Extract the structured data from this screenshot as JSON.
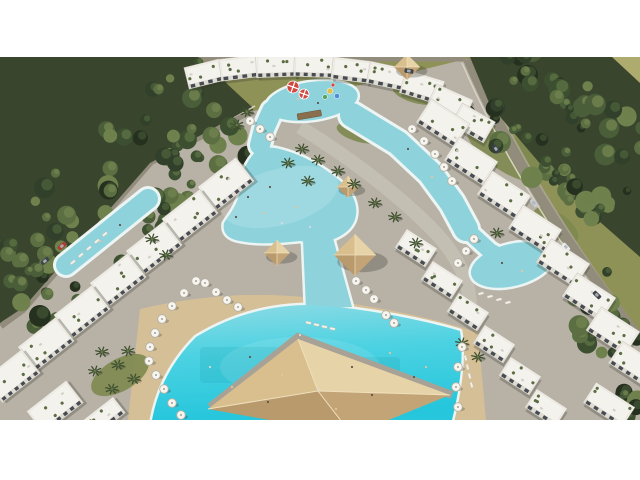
{
  "image": {
    "type": "aerial-architectural-render",
    "subject": "resort-complex-with-lagoon-pools"
  },
  "layout_px": {
    "canvas_w": 640,
    "canvas_h": 363,
    "offset_top": 57
  },
  "scene": {
    "colors": {
      "white": "#ffffff",
      "field": "#8f9257",
      "fieldLight": "#aeab6e",
      "khaki": "#b6ac85",
      "forestBase": "#39462d",
      "treeLight": "#8a9158",
      "paving": "#b7b1a6",
      "pavingLight": "#c9c4b9",
      "sand": "#d5bf97",
      "shore": "#ecf5f3",
      "lagoon": "#8ed3dc",
      "poolTop": "#8fdbe4",
      "poolMid": "#4cd2e2",
      "poolDeep": "#26c6dc",
      "building": "#f4f2ec",
      "buildingShade": "#dedbd2",
      "buildingEdge": "#c6c3b9",
      "roofLine": "#e9e7df",
      "window": "#474b52",
      "roofGreen": "#5c6d44",
      "roofGrey": "#d2cfc6",
      "road": "#928c7c",
      "roadLight": "#a8a291",
      "wall": "#d8d2c2",
      "wallShadow": "rgba(30,35,25,0.4)",
      "shadow": "rgba(45,50,40,0.28)",
      "umbrellaFill": "#f7f5ef",
      "umbrellaEdge": "#b5b1a5",
      "umbrellaDot": "#a39f93",
      "lounger": "#f2f0e8",
      "loungerEdge": "#c2beb2",
      "palm": "#3f5030",
      "palmLight": "#637744",
      "grass": "#7e8950",
      "hutFill": "#d9be8e",
      "hutShade": "#c3a476",
      "hutDark": "#b89a6c",
      "hutLight": "#e7d3a8",
      "ridge": "#efe0bc",
      "pyrWalk": "#a8a296",
      "carDark": "#3f434a",
      "carSilver": "#c9cdd1",
      "carWhite": "#ecedee",
      "carRed": "#b03a31",
      "glass": "#aeb6bc",
      "stripeRed": "#d2473f",
      "slideYellow": "#e3bf4e",
      "slideBlue": "#4d8fd2",
      "slideGreen": "#58a45c",
      "bridge": "#8a6f4e",
      "skin": "#e5c5a0",
      "dark": "#5d564c",
      "laneTint": "rgba(20,150,160,0.16)"
    },
    "treeGreens": [
      "#26301f",
      "#31402a",
      "#3d4f31",
      "#4a5e3a",
      "#5b6f42",
      "#6f814c"
    ],
    "backdrop": {
      "khakiPoly": "0,0 118,0 0,86",
      "fieldLightPoly": "604,0 640,0 640,30",
      "forestPolys": [
        "M0,0 L198,0 L252,50 L150,106 L24,250 L0,266 Z",
        "M470,0 L612,0 L640,26 L640,200 L560,130 L490,48 Z"
      ]
    },
    "forestStrips": [
      [
        -15,
        248,
        235,
        38,
        58,
        90,
        7
      ],
      [
        486,
        20,
        638,
        132,
        55,
        70,
        13
      ],
      [
        580,
        225,
        638,
        330,
        30,
        16,
        21
      ],
      [
        610,
        342,
        640,
        360,
        14,
        8,
        29
      ]
    ],
    "roads": {
      "left": {
        "d": "M252,52 L150,104 L22,252 L0,268",
        "w": 9
      },
      "leftWall": "M255,49 L152,100 L24,248 L2,264",
      "leftShadow": "M248,47 L146,99 L18,247",
      "right": {
        "d": "M468,2 C500,78 552,170 640,282",
        "w": 10
      },
      "rightWall": "M462,6 C495,82 546,172 634,286",
      "rightOuter": "M474,0 C507,76 558,168 640,276",
      "top": {
        "d": "M150,2 L466,2",
        "w": 5
      },
      "path1": {
        "d": "M300,70 Q380,120 430,170 Q470,210 470,250",
        "w": 14
      }
    },
    "grassPatches": [
      [
        505,
        95,
        45,
        18,
        35
      ],
      [
        556,
        168,
        26,
        12,
        35
      ],
      [
        420,
        36,
        28,
        11,
        12
      ],
      [
        120,
        318,
        32,
        16,
        -30
      ],
      [
        360,
        76,
        24,
        9,
        15
      ]
    ],
    "sandPoly": "M140,252 C200,238 260,234 320,242 C380,250 440,262 478,276 L486,363 L128,363 Z",
    "water": {
      "shapes": [
        {
          "t": "ellipse",
          "cx": 312,
          "cy": 44,
          "rx": 46,
          "ry": 19,
          "rot": -8
        },
        {
          "t": "line",
          "pts": [
            [
              272,
              54
            ],
            [
              264,
              72
            ],
            [
              260,
              88
            ]
          ],
          "w": 20
        },
        {
          "t": "path",
          "d": "M258,92 C246,104 240,118 240,132 C238,148 230,156 224,166 C222,176 228,182 240,184 C260,188 280,186 300,184 L308,185 L334,182 C350,176 358,164 356,150 C354,136 344,126 330,116 C314,104 296,96 280,92 C272,90 264,90 258,92 Z"
        },
        {
          "t": "line",
          "pts": [
            [
              352,
              58
            ],
            [
              398,
              86
            ],
            [
              430,
              116
            ],
            [
              452,
              146
            ],
            [
              466,
              172
            ]
          ],
          "w": 24
        },
        {
          "t": "line",
          "pts": [
            [
              466,
              172
            ],
            [
              490,
              194
            ],
            [
              508,
              204
            ]
          ],
          "w": 16
        },
        {
          "t": "ellipse",
          "cx": 512,
          "cy": 208,
          "rx": 42,
          "ry": 21,
          "rot": -14
        },
        {
          "t": "line",
          "pts": [
            [
              148,
              142
            ],
            [
              66,
              208
            ]
          ],
          "w": 20
        },
        {
          "t": "path",
          "d": "M303,183 L333,181 L352,250 L306,252 Z"
        },
        {
          "t": "path",
          "d": "M196,280 C232,258 270,248 310,248 C356,250 420,262 460,274 C464,300 460,330 452,363 L152,363 C158,330 174,302 196,280 Z",
          "fill": "gradient"
        }
      ],
      "lanes": [
        [
          200,
          290,
          80,
          36
        ],
        [
          310,
          300,
          90,
          42
        ]
      ],
      "shallow": [
        [
          280,
          140,
          60,
          28,
          -15,
          0.14
        ],
        [
          300,
          310,
          80,
          30,
          0,
          0.1
        ]
      ]
    },
    "buildingClusters": [
      {
        "name": "top-arc",
        "blocks": [
          [
            186,
            6,
            36,
            22,
            -14
          ],
          [
            220,
            0,
            38,
            22,
            -7
          ],
          [
            256,
            -2,
            40,
            22,
            -2
          ],
          [
            294,
            -2,
            40,
            22,
            2
          ],
          [
            332,
            2,
            38,
            22,
            7
          ],
          [
            368,
            8,
            38,
            22,
            12
          ],
          [
            402,
            18,
            40,
            24,
            17
          ],
          [
            430,
            34,
            40,
            24,
            24
          ],
          [
            454,
            54,
            38,
            24,
            30
          ]
        ]
      },
      {
        "name": "left-row",
        "angle": -38,
        "blocks": [
          [
            202,
            112,
            48,
            30
          ],
          [
            166,
            144,
            48,
            30
          ],
          [
            130,
            176,
            48,
            30
          ],
          [
            94,
            208,
            48,
            30
          ],
          [
            58,
            240,
            48,
            30
          ],
          [
            22,
            272,
            48,
            30
          ],
          [
            -12,
            304,
            48,
            30
          ],
          [
            30,
            336,
            50,
            28
          ],
          [
            78,
            352,
            46,
            20
          ]
        ]
      },
      {
        "name": "right-row-upper",
        "angle": 33,
        "blocks": [
          [
            420,
            52,
            46,
            28
          ],
          [
            448,
            90,
            46,
            28
          ],
          [
            481,
            124,
            46,
            28
          ],
          [
            512,
            158,
            46,
            28
          ],
          [
            540,
            192,
            46,
            28
          ],
          [
            566,
            226,
            46,
            28
          ],
          [
            590,
            260,
            46,
            28
          ],
          [
            612,
            294,
            44,
            26
          ],
          [
            586,
            336,
            46,
            24
          ]
        ]
      },
      {
        "name": "right-row-lower",
        "angle": 33,
        "blocks": [
          [
            398,
            180,
            36,
            22
          ],
          [
            424,
            212,
            36,
            22
          ],
          [
            450,
            244,
            36,
            22
          ],
          [
            476,
            276,
            36,
            22
          ],
          [
            502,
            308,
            36,
            22
          ],
          [
            528,
            340,
            36,
            22
          ]
        ]
      }
    ],
    "huts": [
      [
        348,
        130,
        22
      ],
      [
        277,
        196,
        26
      ],
      [
        355,
        198,
        42
      ],
      [
        407,
        10,
        26
      ]
    ],
    "pyramid": {
      "walkway": "M210,350 L298,280 L452,338",
      "apex": [
        318,
        334
      ],
      "corners": {
        "n": [
          298,
          282
        ],
        "e": [
          450,
          338
        ],
        "s": [
          352,
          378
        ],
        "w": [
          208,
          352
        ]
      }
    },
    "umbrellas": [
      [
        196,
        224
      ],
      [
        184,
        236
      ],
      [
        172,
        249
      ],
      [
        162,
        262
      ],
      [
        155,
        276
      ],
      [
        150,
        290
      ],
      [
        149,
        304
      ],
      [
        156,
        318
      ],
      [
        164,
        332
      ],
      [
        172,
        346
      ],
      [
        181,
        358
      ],
      [
        205,
        226
      ],
      [
        216,
        235
      ],
      [
        227,
        243
      ],
      [
        238,
        250
      ],
      [
        250,
        64
      ],
      [
        260,
        72
      ],
      [
        270,
        80
      ],
      [
        412,
        72
      ],
      [
        424,
        84
      ],
      [
        435,
        97
      ],
      [
        444,
        110
      ],
      [
        452,
        124
      ],
      [
        474,
        182
      ],
      [
        466,
        194
      ],
      [
        458,
        206
      ],
      [
        356,
        224
      ],
      [
        366,
        233
      ],
      [
        374,
        242
      ],
      [
        386,
        258
      ],
      [
        394,
        266
      ],
      [
        462,
        290
      ],
      [
        458,
        310
      ],
      [
        456,
        330
      ],
      [
        458,
        350
      ]
    ],
    "palms": [
      [
        302,
        92
      ],
      [
        318,
        103
      ],
      [
        338,
        114
      ],
      [
        354,
        127
      ],
      [
        288,
        106
      ],
      [
        308,
        124
      ],
      [
        375,
        146
      ],
      [
        395,
        160
      ],
      [
        152,
        182
      ],
      [
        166,
        198
      ],
      [
        102,
        295
      ],
      [
        118,
        308
      ],
      [
        134,
        322
      ],
      [
        112,
        332
      ],
      [
        95,
        314
      ],
      [
        128,
        294
      ],
      [
        247,
        55
      ],
      [
        237,
        68
      ],
      [
        462,
        286
      ],
      [
        478,
        300
      ],
      [
        497,
        176
      ],
      [
        416,
        186
      ]
    ],
    "loungerRows": [
      [
        70,
        206,
        -40,
        5,
        8,
        -7
      ],
      [
        478,
        236,
        -14,
        4,
        9,
        3
      ],
      [
        466,
        298,
        75,
        4,
        2,
        9
      ],
      [
        306,
        264,
        12,
        4,
        8,
        2
      ]
    ],
    "cars": [
      [
        409,
        14,
        10,
        "carDark"
      ],
      [
        496,
        92,
        55,
        "carDark"
      ],
      [
        534,
        146,
        50,
        "carSilver"
      ],
      [
        566,
        190,
        47,
        "carWhite"
      ],
      [
        597,
        238,
        44,
        "carDark"
      ],
      [
        62,
        189,
        -40,
        "carRed"
      ],
      [
        45,
        204,
        -40,
        "carDark"
      ]
    ],
    "people": [
      [
        248,
        140,
        0
      ],
      [
        264,
        156,
        1
      ],
      [
        282,
        166,
        2
      ],
      [
        236,
        160,
        0
      ],
      [
        296,
        150,
        1
      ],
      [
        270,
        130,
        0
      ],
      [
        310,
        170,
        2
      ],
      [
        298,
        42,
        1
      ],
      [
        318,
        46,
        0
      ],
      [
        408,
        92,
        0
      ],
      [
        432,
        120,
        1
      ],
      [
        502,
        206,
        0
      ],
      [
        522,
        214,
        1
      ],
      [
        250,
        300,
        0
      ],
      [
        282,
        318,
        1
      ],
      [
        318,
        332,
        2
      ],
      [
        352,
        310,
        0
      ],
      [
        390,
        296,
        1
      ],
      [
        414,
        320,
        0
      ],
      [
        300,
        278,
        2
      ],
      [
        232,
        330,
        1
      ],
      [
        268,
        345,
        0
      ],
      [
        336,
        352,
        1
      ],
      [
        372,
        338,
        0
      ],
      [
        210,
        310,
        2
      ],
      [
        426,
        310,
        1
      ],
      [
        120,
        168,
        0
      ],
      [
        100,
        184,
        1
      ]
    ],
    "waterpark": {
      "stripedUmbrellas": [
        [
          293,
          30,
          6
        ],
        [
          304,
          37,
          5
        ]
      ],
      "features": [
        [
          330,
          34,
          "slideYellow",
          3
        ],
        [
          337,
          39,
          "slideBlue",
          2.6
        ],
        [
          325,
          40,
          "slideGreen",
          2.4
        ],
        [
          333,
          28,
          "stripeRed",
          2
        ]
      ],
      "bridge": [
        297,
        57,
        24,
        6,
        -10
      ]
    }
  }
}
